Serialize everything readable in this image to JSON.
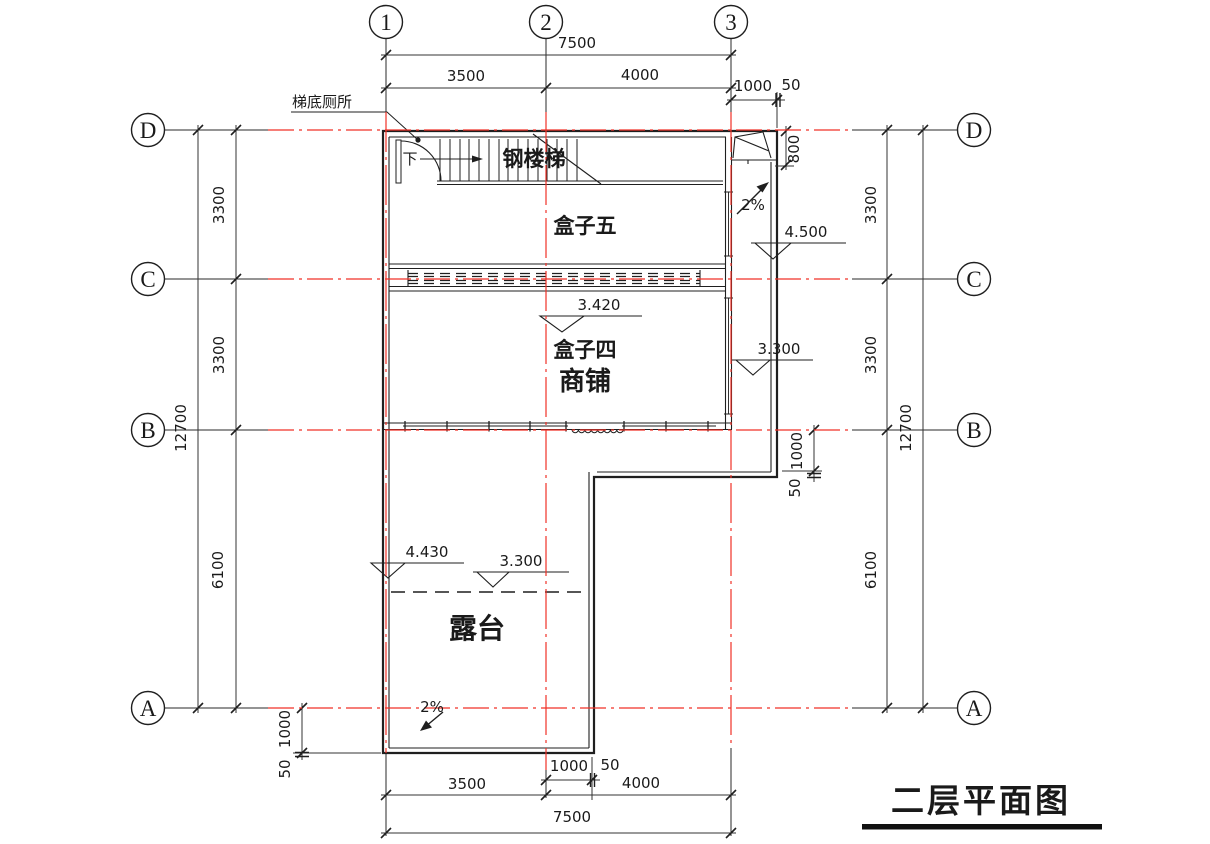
{
  "drawing_title": "二层平面图",
  "axes": {
    "cols": [
      "1",
      "2",
      "3"
    ],
    "rows": [
      "D",
      "C",
      "B",
      "A"
    ]
  },
  "rooms": {
    "box5": "盒子五",
    "box4": "盒子四",
    "shop": "商铺",
    "terrace": "露台"
  },
  "stair": {
    "label": "钢楼梯",
    "down": "下",
    "toilet_note": "梯底厕所"
  },
  "slope": {
    "value": "2%"
  },
  "elevations": {
    "v4500": "4.500",
    "v3420": "3.420",
    "v3300": "3.300",
    "v4430": "4.430"
  },
  "dims": {
    "d7500": "7500",
    "d3500": "3500",
    "d4000": "4000",
    "d1000": "1000",
    "d50": "50",
    "d800": "800",
    "d3300": "3300",
    "d6100": "6100",
    "d12700": "12700"
  },
  "colors": {
    "grid_red": "#f03127",
    "ink": "#1f1f1f",
    "background": "#ffffff"
  }
}
